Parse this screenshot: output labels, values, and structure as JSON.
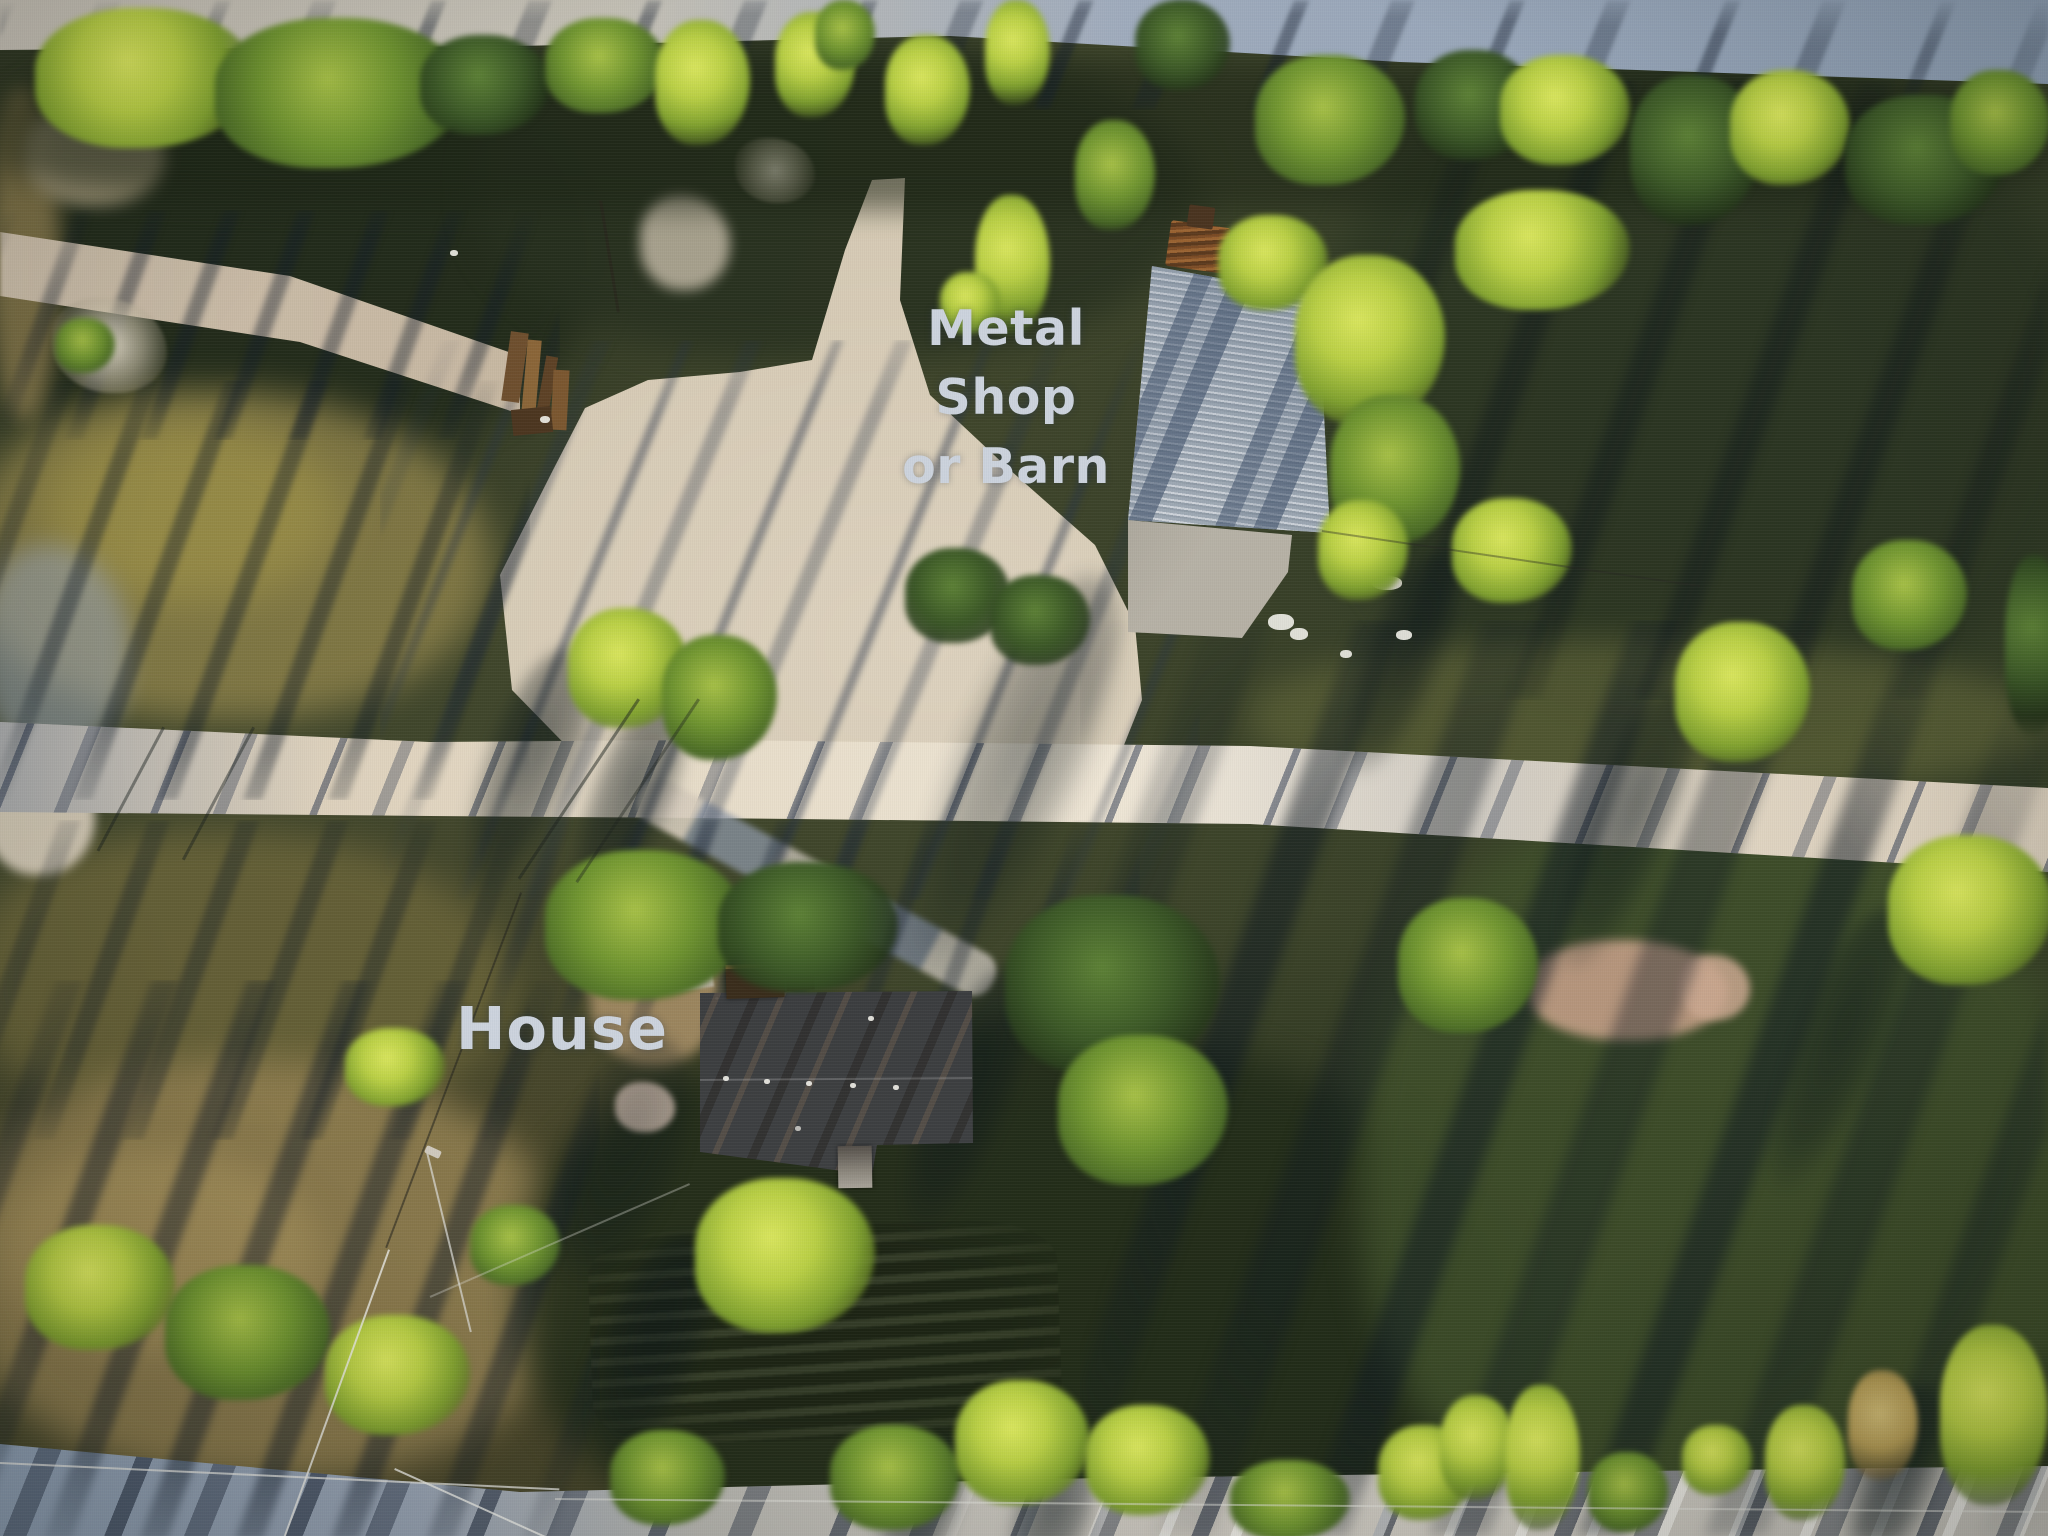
{
  "image": {
    "kind": "aerial drone photograph, top-down",
    "lighting": "low golden-hour sun, long shadows toward lower-left",
    "width_px": 2048,
    "height_px": 1536
  },
  "annotations": {
    "barn_label": {
      "lines": [
        "Metal",
        "Shop",
        "or Barn"
      ]
    },
    "house_label": {
      "text": "House"
    }
  },
  "scene": {
    "structures": [
      {
        "name": "metal shop or barn",
        "roof": "light gray corrugated metal with tree shadows",
        "adjacent": "concrete slab pad with debris"
      },
      {
        "name": "house",
        "roof": "dark shingle roof, upper slope sunlit brown, chimney block, rear shed"
      }
    ],
    "ground_features": [
      "white gravel road crossing center",
      "gravel road along top edge",
      "road band along bottom edge",
      "branch dirt track at upper left",
      "concrete driveway from road to house",
      "large sandy clearing in front of barn",
      "scattered sunlit trees",
      "long evening tree shadows",
      "sunlit tan field lower left",
      "power lines at lower left",
      "lumber debris pile left of clearing"
    ]
  },
  "colors": {
    "label_text": "#ccd3dd",
    "road_sunlit": "#e8decb",
    "road_shaded": "#8e9fb4",
    "sand_clearing": "#d3c7b1",
    "barn_roof_light": "#cdd3d8",
    "barn_roof_mid": "#9aa6af",
    "barn_shadow": "#4c6486",
    "concrete_pad": "#b5b0a4",
    "house_roof_dark": "#3d3f41",
    "house_roof_sunlit": "#9e744e",
    "tree_bright": "#b9cf45",
    "tree_mid": "#6f9430",
    "tree_dark": "#3a5626",
    "grass_gold": "#8a7f48",
    "grass_dark": "#2b3522",
    "field_tan": "#8d7c4e",
    "shadow_band": "#141f2e"
  }
}
